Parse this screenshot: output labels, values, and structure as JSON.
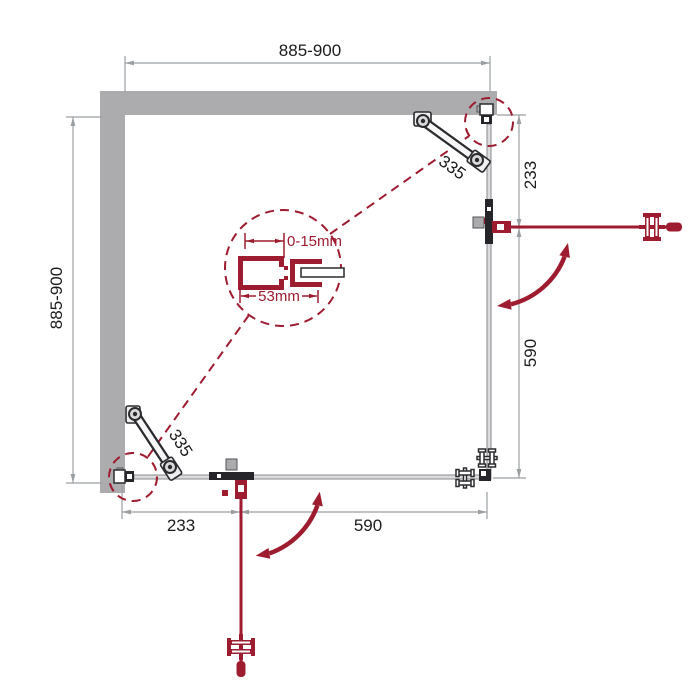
{
  "dimensions": {
    "top": "885-900",
    "left": "885-900",
    "right_upper": "233",
    "right_lower": "590",
    "bottom_left": "233",
    "bottom_right": "590"
  },
  "supports": {
    "top_right_length": "335",
    "bottom_left_length": "335"
  },
  "detail": {
    "adjustment_range": "0-15mm",
    "profile_width": "53mm"
  },
  "colors": {
    "wall_gray": "#ACACAE",
    "glass_gray": "#8A8A8C",
    "dimension_gray": "#9B9FA2",
    "label_text": "#1B1B1B",
    "accent_red": "#9E1C2F",
    "fitting_dark": "#26262A"
  }
}
